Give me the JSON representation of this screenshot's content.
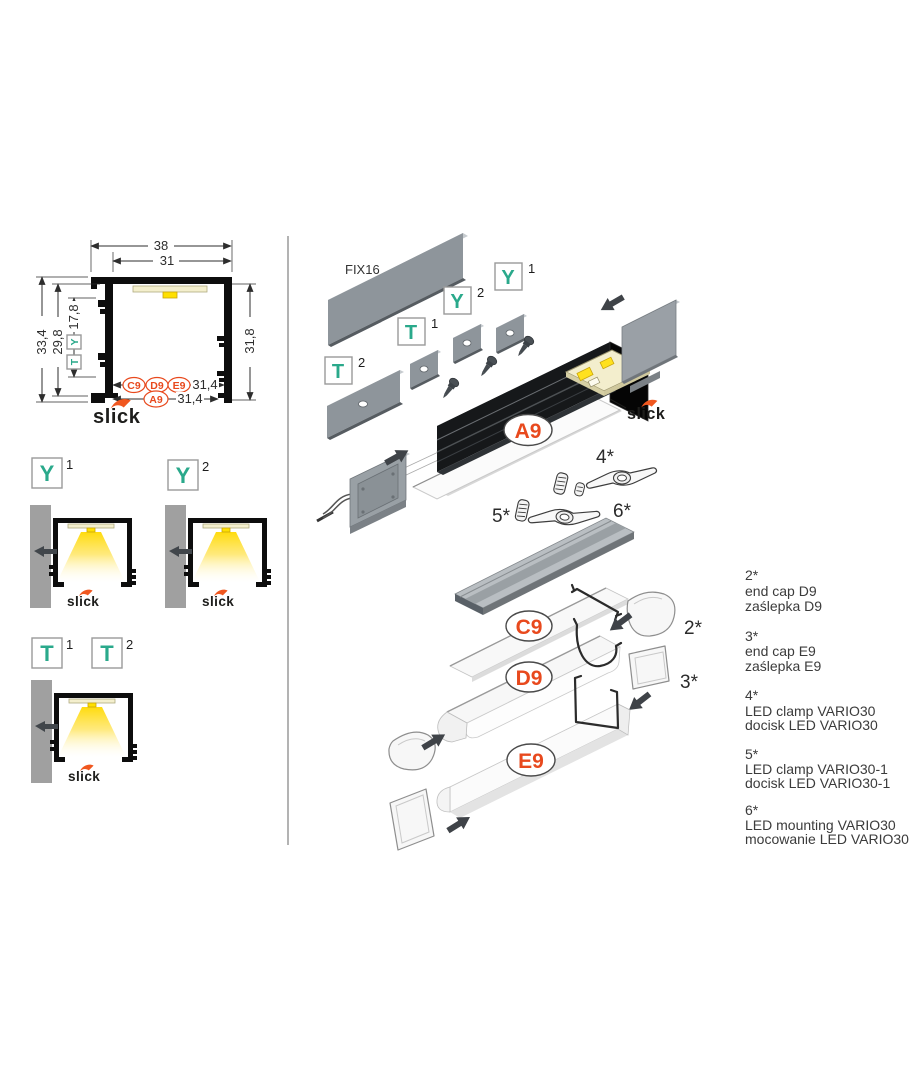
{
  "colors": {
    "teal": "#2aa98b",
    "label_orange": "#e8491d",
    "swoosh_orange": "#f0571f"
  },
  "brand": {
    "slick": "slick"
  },
  "cross_section": {
    "dim_width_outer": "38",
    "dim_width_inner": "31",
    "dim_height_outer": "33,4",
    "dim_height_mid": "29,8",
    "dim_height_inner": "17,8",
    "dim_height_right": "31,8",
    "dim_opening_top": "31,4",
    "dim_opening_bottom": "31,4",
    "variant_y": "Y",
    "variant_t": "T",
    "cover_c9": "C9",
    "cover_d9": "D9",
    "cover_e9": "E9",
    "profile_a9": "A9"
  },
  "variants": {
    "y1": {
      "letter": "Y",
      "sup": "1"
    },
    "y2": {
      "letter": "Y",
      "sup": "2"
    },
    "t1": {
      "letter": "T",
      "sup": "1"
    },
    "t2": {
      "letter": "T",
      "sup": "2"
    }
  },
  "exploded": {
    "fix16_label": "FIX16",
    "profile_a9": "A9",
    "cover_c9": "C9",
    "cover_d9": "D9",
    "cover_e9": "E9",
    "callout_2": "2*",
    "callout_3": "3*",
    "callout_4": "4*",
    "callout_5": "5*",
    "callout_6": "6*"
  },
  "parts_list": [
    {
      "num": "2*",
      "en": "end cap D9",
      "pl": "zaślepka D9"
    },
    {
      "num": "3*",
      "en": "end cap E9",
      "pl": "zaślepka E9"
    },
    {
      "num": "4*",
      "en": "LED clamp VARIO30",
      "pl": "docisk LED VARIO30"
    },
    {
      "num": "5*",
      "en": "LED clamp VARIO30-1",
      "pl": "docisk LED VARIO30-1"
    },
    {
      "num": "6*",
      "en": "LED mounting VARIO30",
      "pl": "mocowanie LED VARIO30"
    }
  ]
}
